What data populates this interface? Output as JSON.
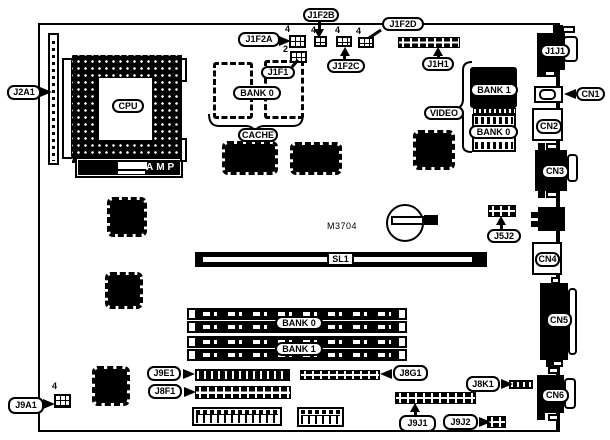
{
  "diagram": {
    "type": "motherboard-layout",
    "background": "#ffffff",
    "ink": "#000000",
    "labels": {
      "j2a1": "J2A1",
      "cpu": "CPU",
      "amp": "AMP",
      "j1f2a": "J1F2A",
      "j1f2b": "J1F2B",
      "j1f2c": "J1F2C",
      "j1f2d": "J1F2D",
      "j1f1": "J1F1",
      "j1h1": "J1H1",
      "cache_bank0": "BANK 0",
      "cache": "CACHE",
      "video": "VIDEO",
      "video_bank1": "BANK 1",
      "video_bank0": "BANK 0",
      "j1j1": "J1J1",
      "cn1": "CN1",
      "cn2": "CN2",
      "cn3": "CN3",
      "cn4": "CN4",
      "cn5": "CN5",
      "cn6": "CN6",
      "m3704": "M3704",
      "sl1": "SL1",
      "j5j2": "J5J2",
      "simm_bank0": "BANK 0",
      "simm_bank1": "BANK 1",
      "j9e1": "J9E1",
      "j8f1": "J8F1",
      "j8g1": "J8G1",
      "j8k1": "J8K1",
      "j9j1": "J9J1",
      "j9j2": "J9J2",
      "j9a1": "J9A1"
    },
    "pin_counts": {
      "j1f2a": "4",
      "j1f2b": "4",
      "j1f2c": "4",
      "j1f2d": "4",
      "j1f1": "2",
      "j9a1": "4"
    }
  }
}
